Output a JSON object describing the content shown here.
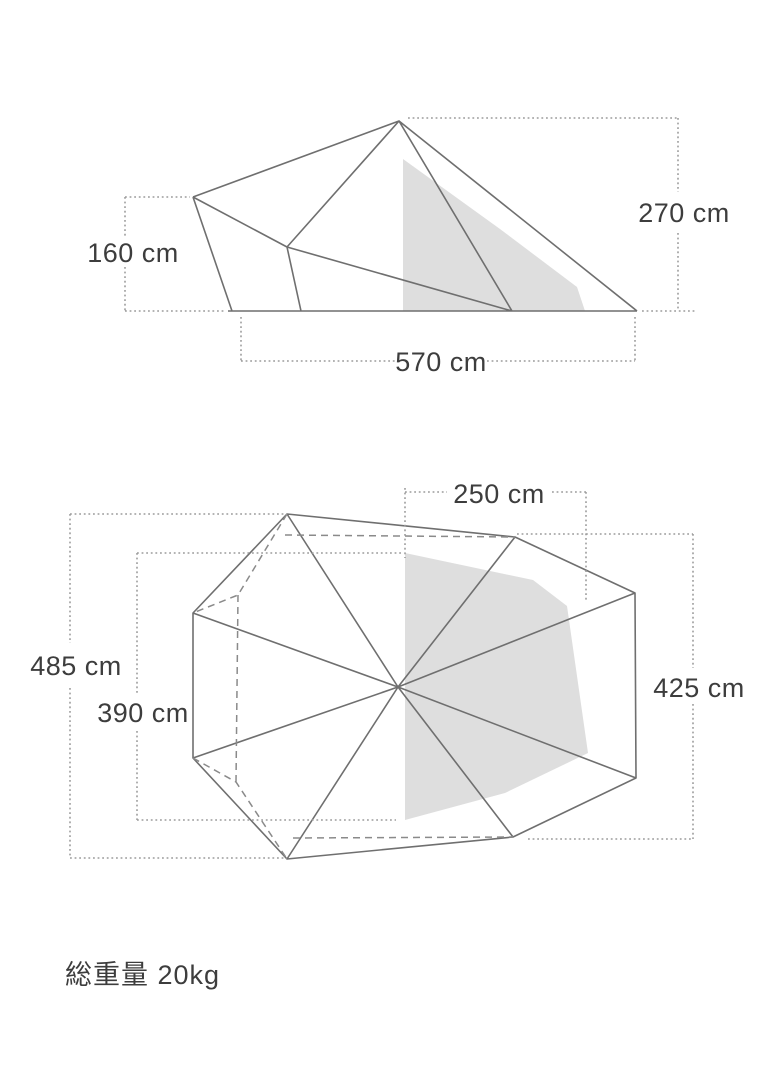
{
  "side_view": {
    "title": "tent side elevation with dimensions",
    "labels": {
      "peak_height": "270 cm",
      "side_height": "160 cm",
      "base_width": "570 cm"
    }
  },
  "top_view": {
    "title": "tent floor plan with dimensions",
    "labels": {
      "inner_half_width": "250 cm",
      "outer_length": "485 cm",
      "inner_length": "390 cm",
      "width": "425 cm"
    }
  },
  "footer": {
    "total_weight": "総重量 20kg"
  },
  "colors": {
    "outline_line": "#6f6f6f",
    "dashed_line": "#8a8a8a",
    "dotted_dimension_line": "#9c9c9c",
    "shade_fill": "#dedede",
    "text": "#3d3d3d",
    "background": "#ffffff"
  }
}
